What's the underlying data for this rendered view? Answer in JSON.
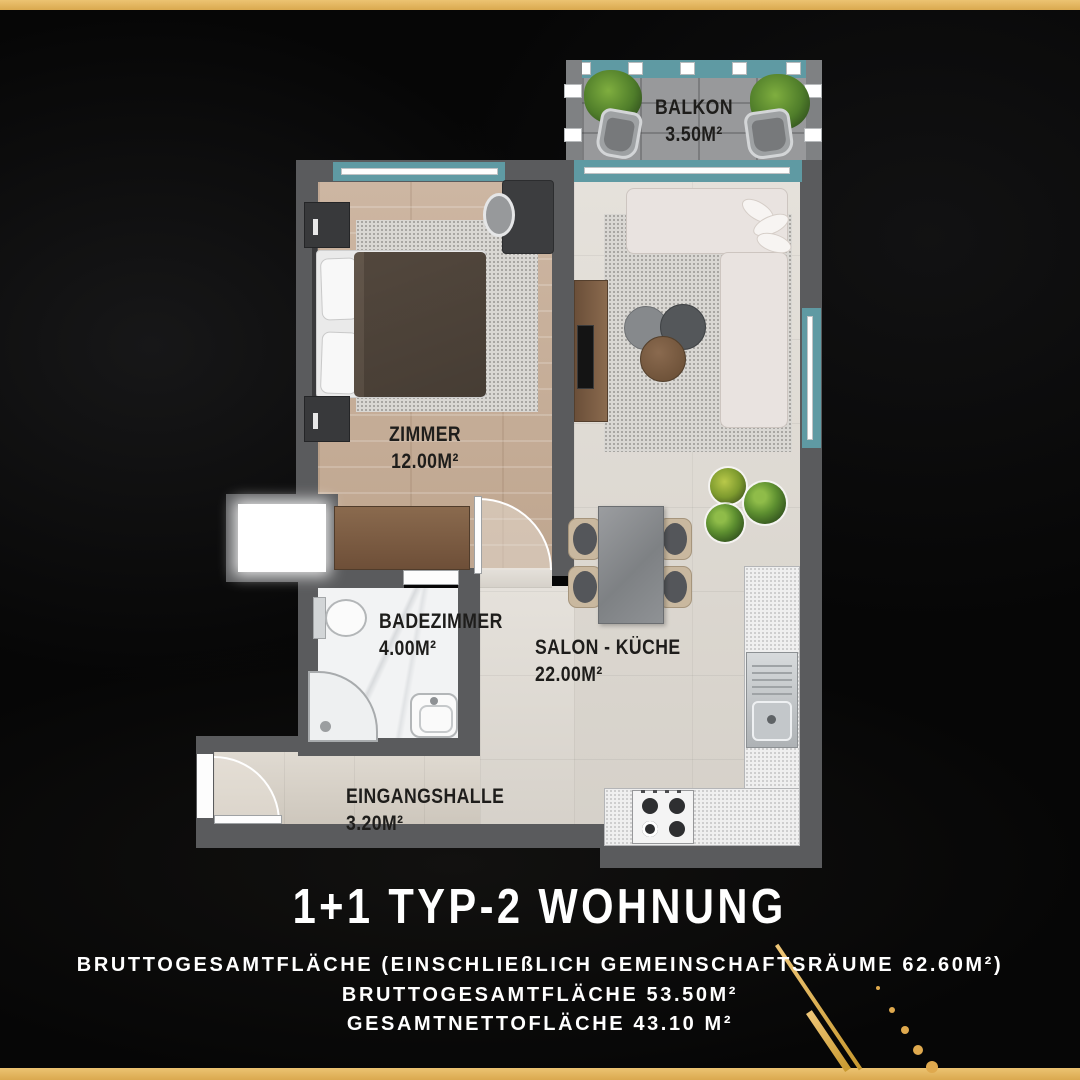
{
  "header": {
    "title": "1+1 TYP-2 WOHNUNG"
  },
  "footer": {
    "line1": "BRUTTOGESAMTFLÄCHE (EINSCHLIEßLICH GEMEINSCHAFTSRÄUME 62.60M²)",
    "line2": "BRUTTOGESAMTFLÄCHE 53.50M²",
    "line3": "GESAMTNETTOFLÄCHE 43.10 M²"
  },
  "rooms": {
    "balkon": {
      "label": "BALKON",
      "area": "3.50M²"
    },
    "zimmer": {
      "label": "ZIMMER",
      "area": "12.00M²"
    },
    "badezimmer": {
      "label": "BADEZIMMER",
      "area": "4.00M²"
    },
    "salon": {
      "label": "SALON - KÜCHE",
      "area": "22.00M²"
    },
    "eingangshalle": {
      "label": "EINGANGSHALLE",
      "area": "3.20M²"
    }
  },
  "colors": {
    "gold": "#E3B261",
    "wall_gray": "#5A5B5D",
    "window_teal": "#5F9AA3",
    "background": "#060606",
    "label_black": "#1E1D1B",
    "text_white": "#FFFFFF"
  }
}
